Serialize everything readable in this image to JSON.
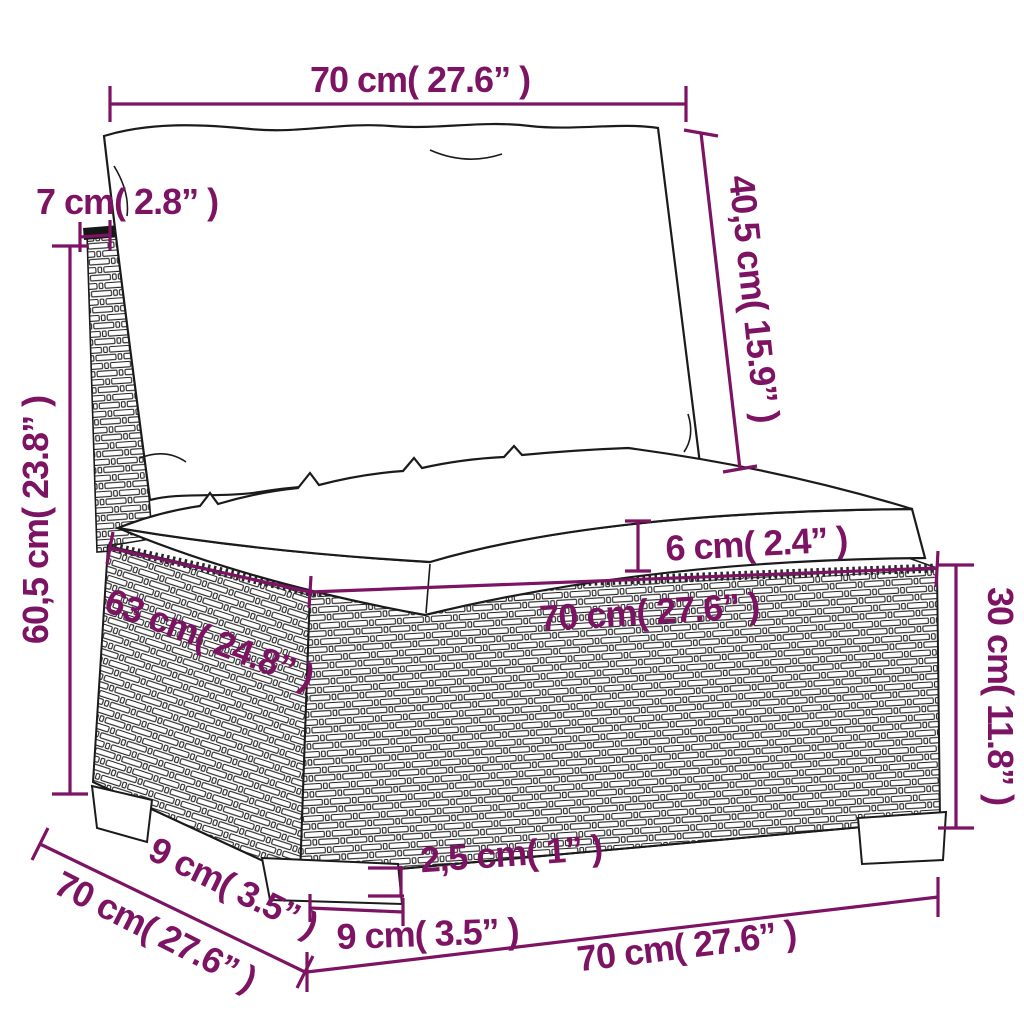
{
  "diagram": {
    "type": "furniture-dimension-diagram",
    "subject": "rattan garden middle sofa section with back and seat cushions",
    "units": [
      "cm",
      "inches"
    ],
    "colors": {
      "dimension": "#7d1463",
      "outline": "#1b1b1b",
      "background": "#ffffff"
    },
    "labels": {
      "back_cushion_width": "70 cm( 27.6” )",
      "backrest_thickness": "7 cm( 2.8” )",
      "back_cushion_height": "40,5 cm( 15.9” )",
      "total_height": "60,5 cm( 23.8” )",
      "seat_cushion_thickness": "6 cm( 2.4” )",
      "seat_width": "70 cm( 27.6” )",
      "seat_depth": "63 cm( 24.8” )",
      "base_height": "30 cm( 11.8” )",
      "leg_height": "2,5 cm( 1” )",
      "front_leg_width": "9 cm( 3.5” )",
      "side_leg_depth": "9 cm( 3.5” )",
      "side_depth": "70 cm( 27.6” )",
      "front_width_bottom": "70 cm( 27.6” )"
    },
    "measurements": [
      {
        "name": "back cushion width",
        "cm": 70,
        "inch": 27.6
      },
      {
        "name": "backrest thickness",
        "cm": 7,
        "inch": 2.8
      },
      {
        "name": "back cushion height",
        "cm": 40.5,
        "inch": 15.9
      },
      {
        "name": "total height",
        "cm": 60.5,
        "inch": 23.8
      },
      {
        "name": "seat cushion thickness",
        "cm": 6,
        "inch": 2.4
      },
      {
        "name": "seat width",
        "cm": 70,
        "inch": 27.6
      },
      {
        "name": "seat depth",
        "cm": 63,
        "inch": 24.8
      },
      {
        "name": "base height",
        "cm": 30,
        "inch": 11.8
      },
      {
        "name": "leg height",
        "cm": 2.5,
        "inch": 1
      },
      {
        "name": "front leg width",
        "cm": 9,
        "inch": 3.5
      },
      {
        "name": "side leg depth",
        "cm": 9,
        "inch": 3.5
      },
      {
        "name": "side depth",
        "cm": 70,
        "inch": 27.6
      },
      {
        "name": "front width bottom",
        "cm": 70,
        "inch": 27.6
      }
    ]
  }
}
